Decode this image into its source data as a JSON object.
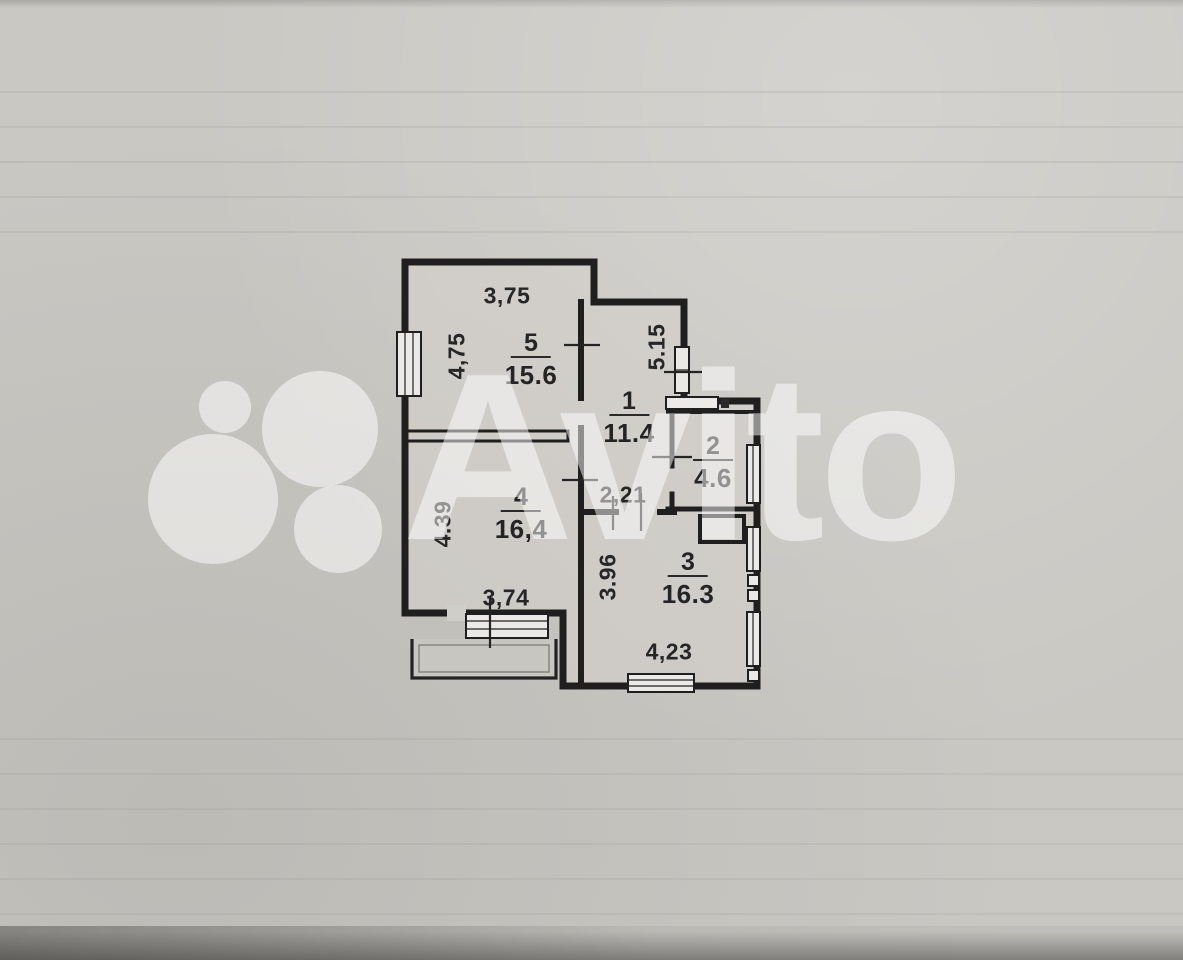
{
  "watermark": {
    "brand": "Avito",
    "color": "#ffffff"
  },
  "colors": {
    "paper": "#cac8c3",
    "ink": "#242424"
  },
  "plan": {
    "rooms": [
      {
        "number": "5",
        "area": "15.6"
      },
      {
        "number": "1",
        "area": "11.4"
      },
      {
        "number": "2",
        "area": "4.6"
      },
      {
        "number": "4",
        "area": "16,4"
      },
      {
        "number": "3",
        "area": "16.3"
      }
    ],
    "dimensions": [
      {
        "label": "3,75"
      },
      {
        "label": "4,75"
      },
      {
        "label": "5.15"
      },
      {
        "label": "2,21"
      },
      {
        "label": "4.39"
      },
      {
        "label": "3,74"
      },
      {
        "label": "3.96"
      },
      {
        "label": "4,23"
      }
    ]
  }
}
